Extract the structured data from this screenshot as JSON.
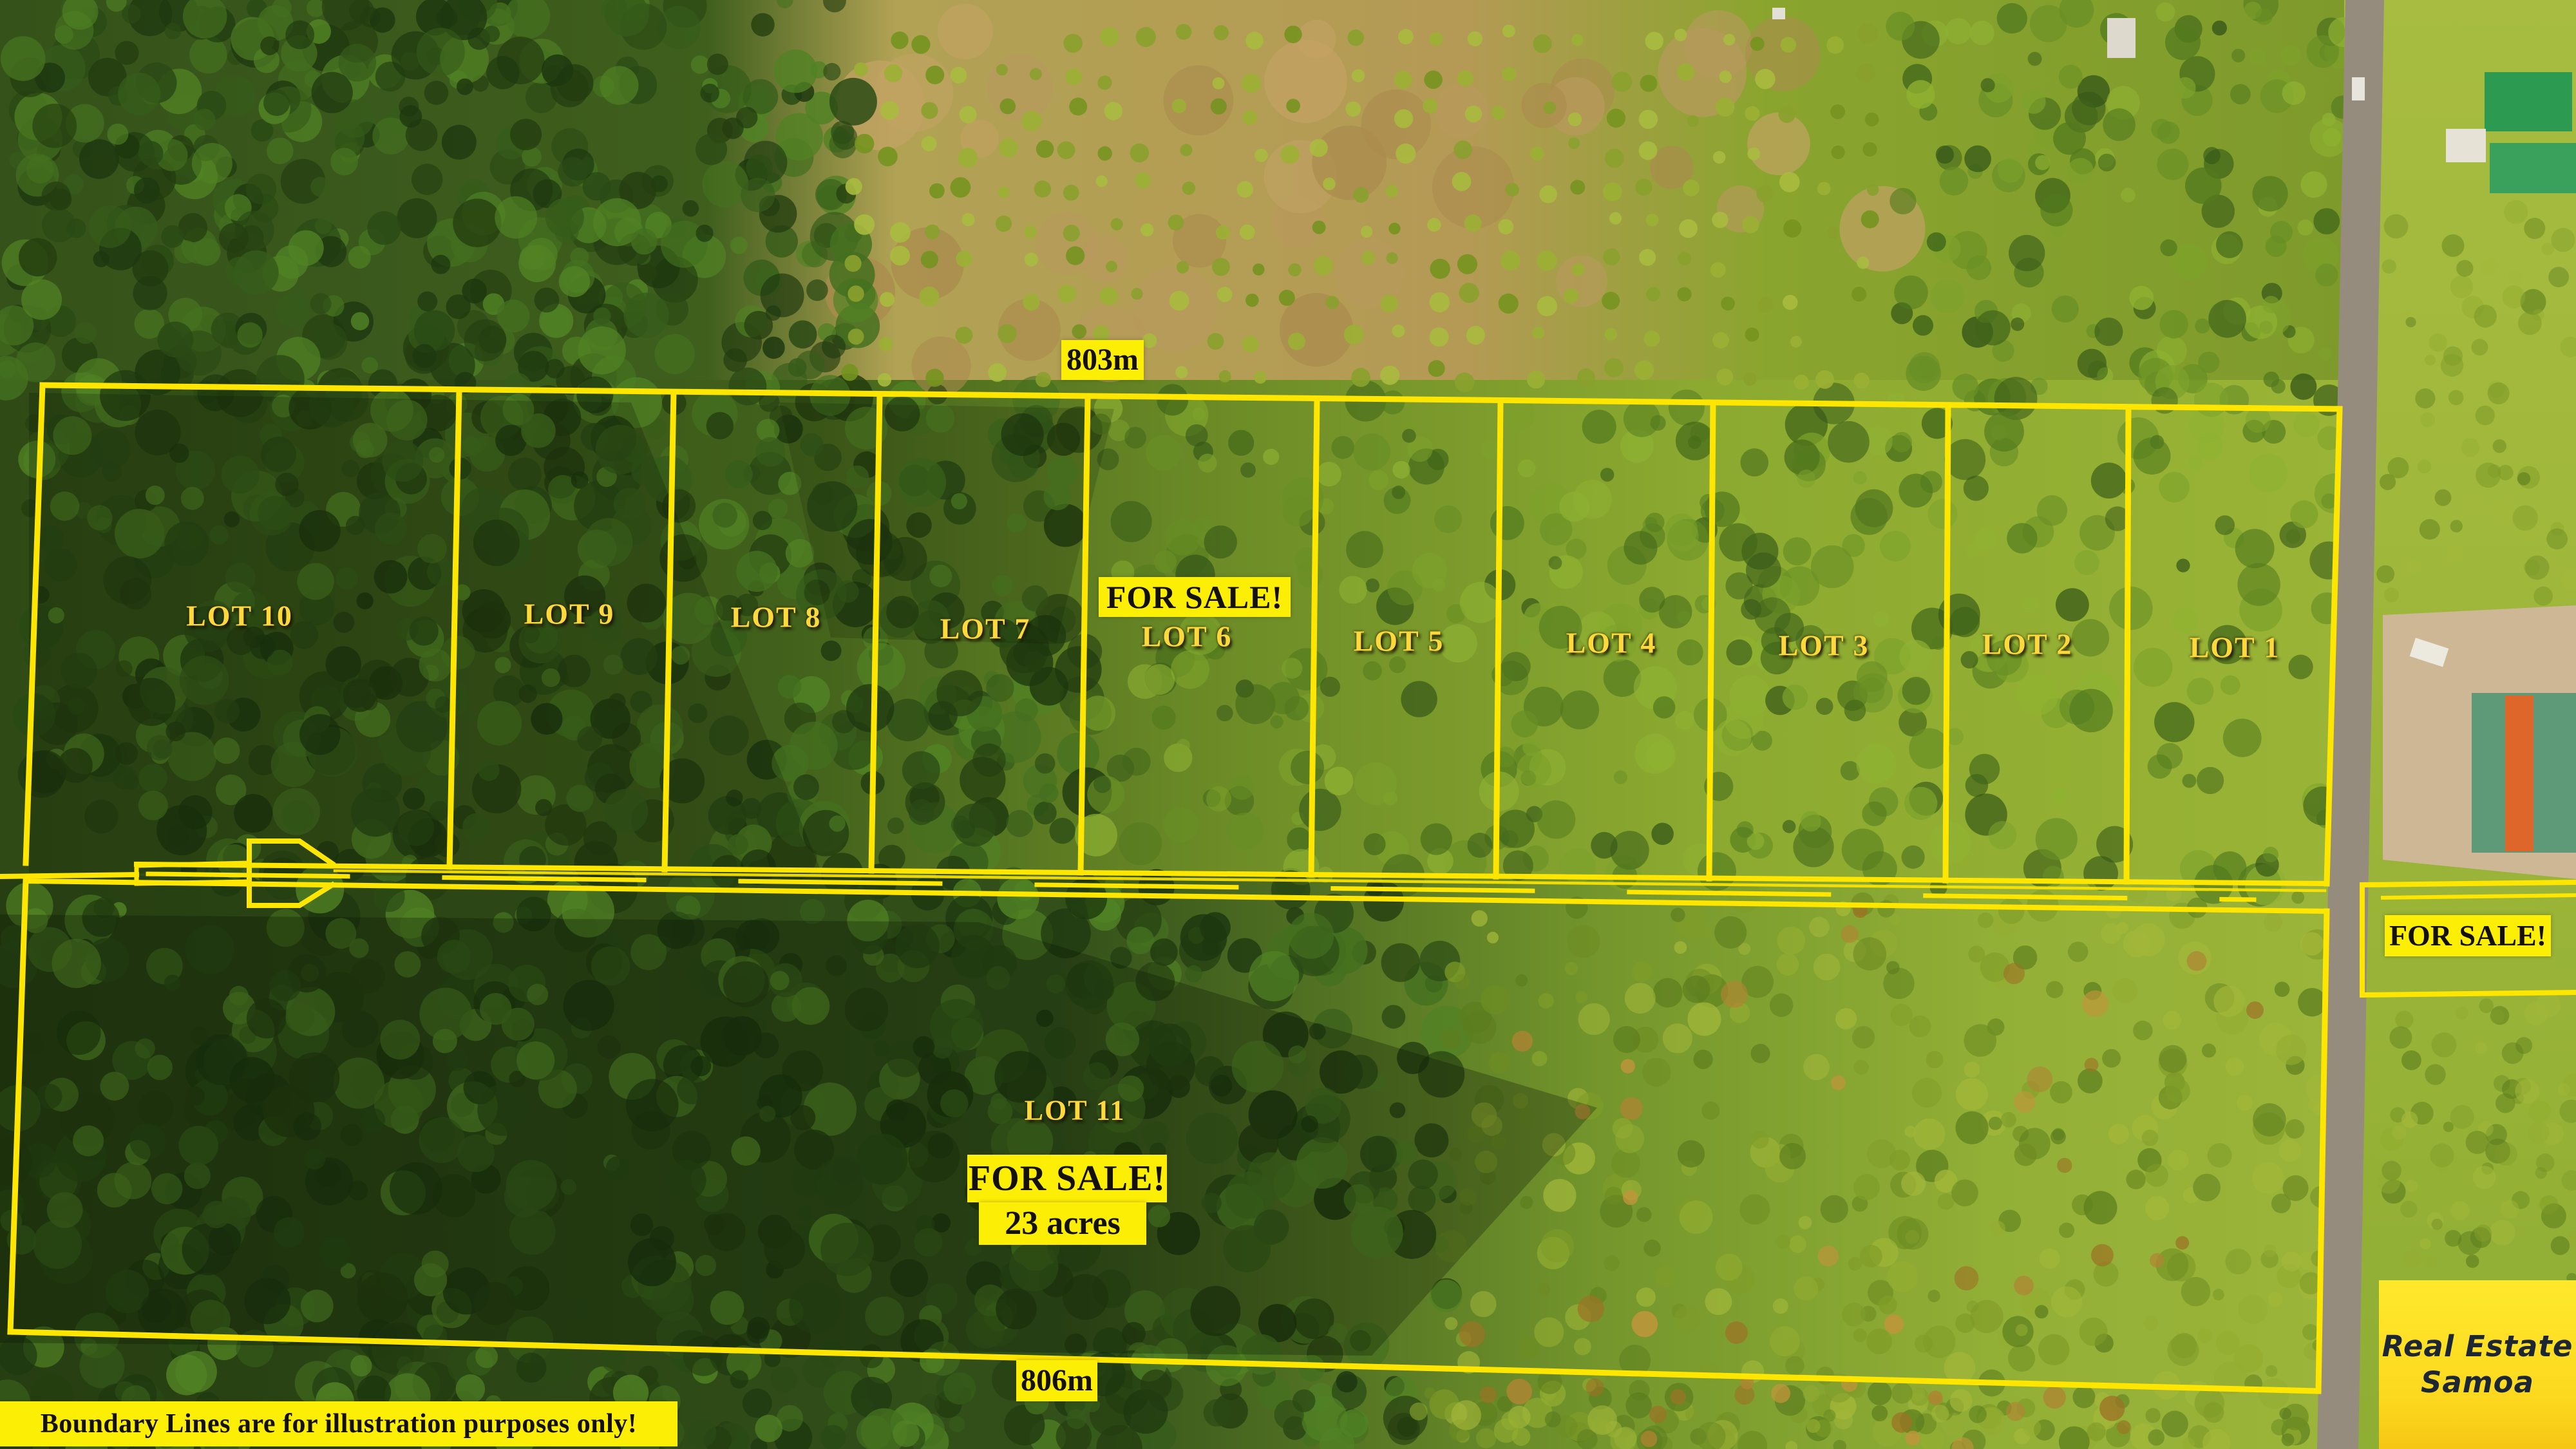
{
  "scene": {
    "description": "aerial drone photo of subdivided farmland lots beside a road",
    "features": [
      "forest",
      "plantation-clearing",
      "main-road",
      "parking-area",
      "green-roof-building",
      "sports-field"
    ]
  },
  "measurements": {
    "top_width": "803m",
    "bottom_width": "806m"
  },
  "lots": {
    "lot1": "LOT 1",
    "lot2": "LOT 2",
    "lot3": "LOT 3",
    "lot4": "LOT 4",
    "lot5": "LOT 5",
    "lot6": "LOT 6",
    "lot7": "LOT 7",
    "lot8": "LOT 8",
    "lot9": "LOT 9",
    "lot10": "LOT 10",
    "lot11": "LOT 11"
  },
  "sale": {
    "lot6_banner": "FOR SALE!",
    "lot11_banner": "FOR SALE!",
    "lot11_area": "23 acres",
    "roadside_banner": "FOR SALE!"
  },
  "disclaimer": "Boundary Lines are for illustration purposes only!",
  "brand": {
    "name_line1": "Real Estate",
    "name_line2": "Samoa"
  },
  "colors": {
    "boundary_yellow": "#ffe600",
    "sign_background": "#fdee05",
    "sign_text": "#14110a",
    "lot_label_text": "#ffd83b",
    "brand_background": "#ffe226",
    "brand_text": "#1c2733",
    "road_gray": "#968c7e"
  }
}
